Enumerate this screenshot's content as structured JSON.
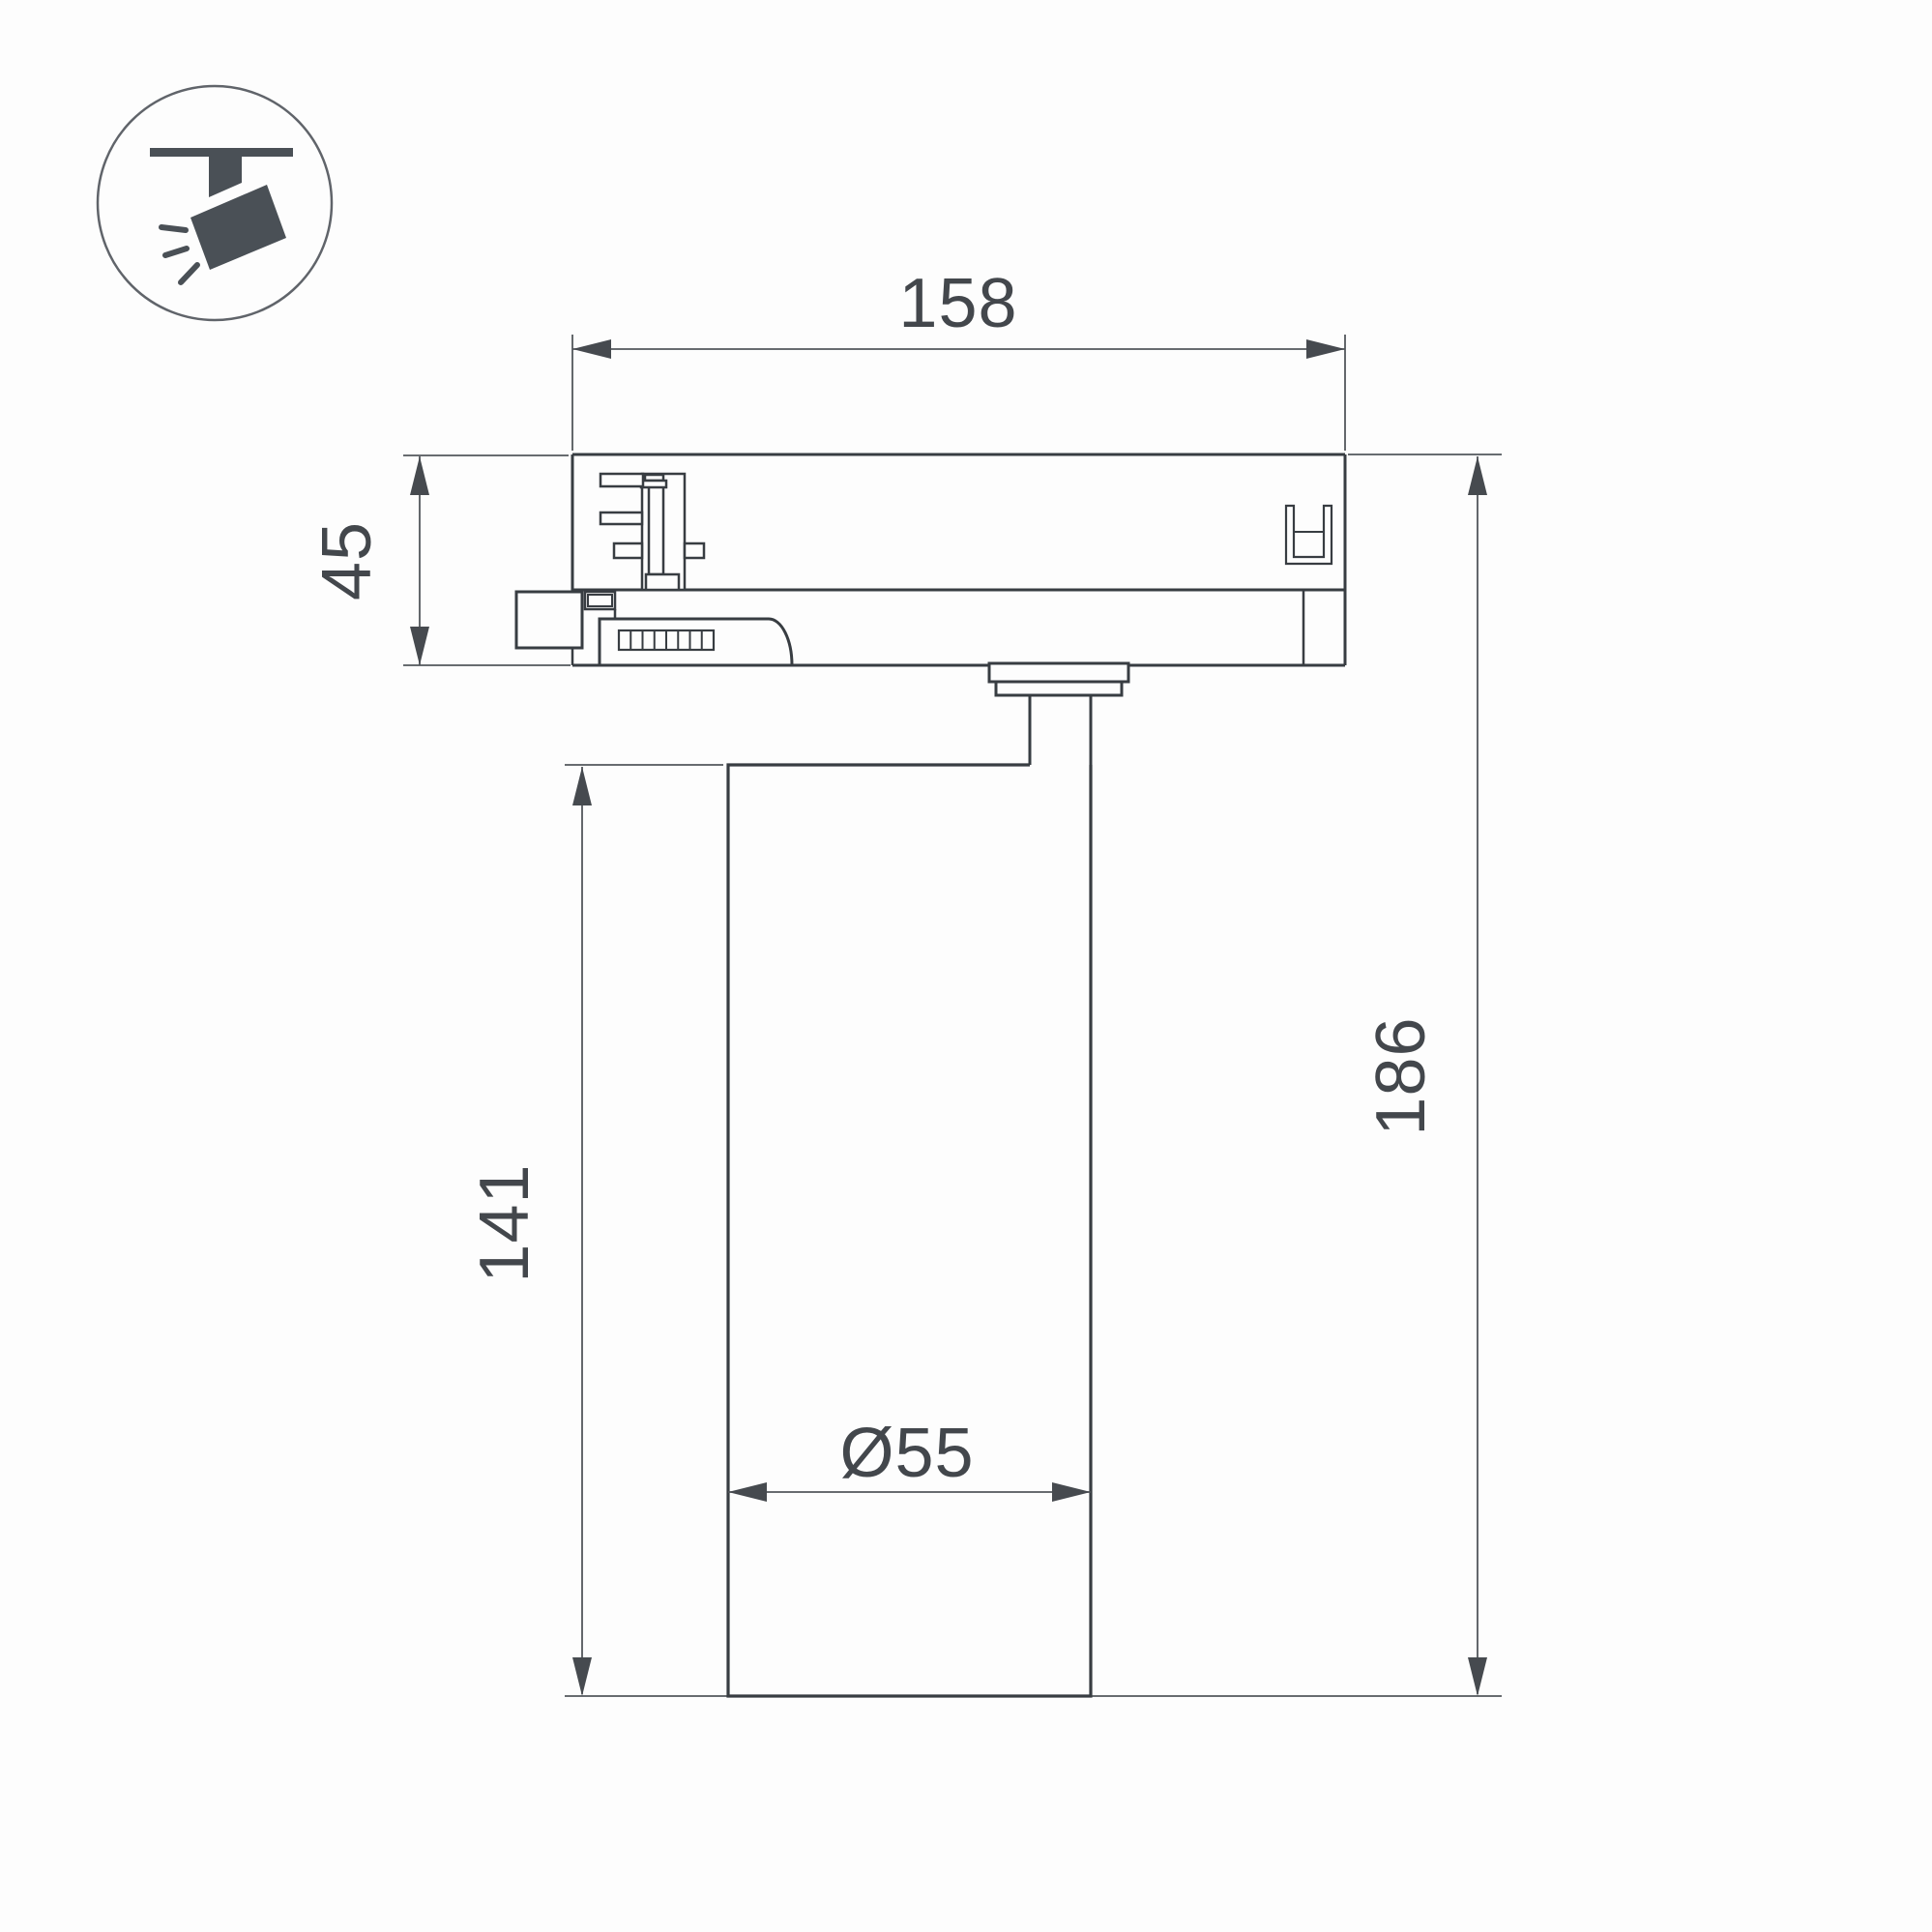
{
  "page": {
    "background": "#fdfdfd"
  },
  "icon": {
    "name": "ceiling-track-spotlight",
    "ring_color": "#60646a",
    "glyph_color": "#4a5056"
  },
  "drawing": {
    "part_line_color": "#383d42",
    "dimension_line_color": "#53575c",
    "text_color": "#43474c",
    "labels": {
      "adapter_width": "158",
      "adapter_height": "45",
      "body_height": "141",
      "total_height": "186",
      "body_diameter": "Ø55"
    }
  }
}
